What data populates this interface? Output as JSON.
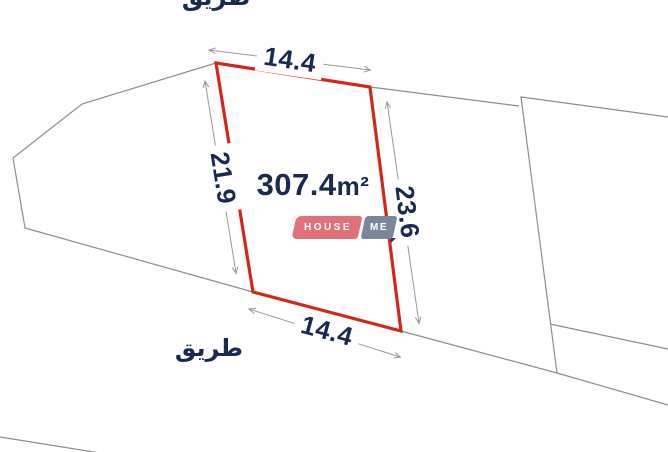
{
  "diagram": {
    "area_value": "307.4",
    "area_unit": "m²",
    "dim_top": "14.4",
    "dim_bottom": "14.4",
    "dim_left": "21.9",
    "dim_right": "23.6",
    "road_label_top": "طريق",
    "road_label_bottom": "طريق"
  },
  "logo": {
    "part1": "HOUSE",
    "part2": "ME"
  },
  "colors": {
    "plot_outline": "#d6251b",
    "navy_text": "#1a2a52",
    "parcel_line": "#8e8e8e",
    "dimension_line": "#999999",
    "logo_red": "#e0717b",
    "logo_gray": "#7b8799",
    "logo_fold": "#2a3553"
  }
}
